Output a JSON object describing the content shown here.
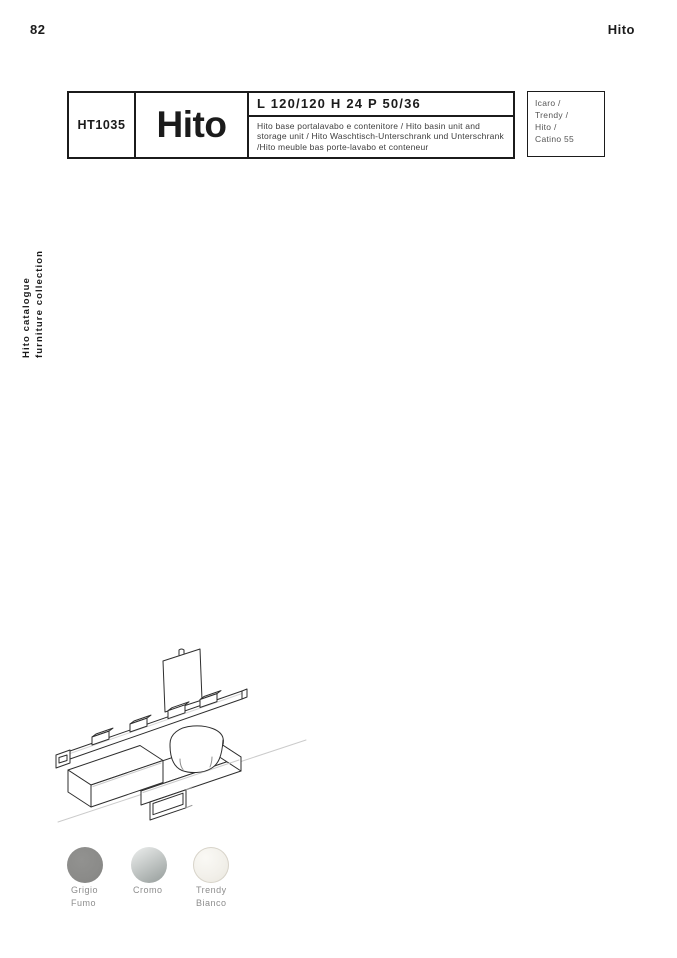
{
  "page": {
    "number": "82",
    "brand": "Hito"
  },
  "side_label": {
    "line1": "Hito catalogue",
    "line2": "furniture collection"
  },
  "product": {
    "code": "HT1035",
    "name": "Hito",
    "dimensions": "L 120/120 H 24 P 50/36",
    "description": "Hito base portalavabo e contenitore / Hito basin unit and storage unit / Hito Waschtisch-Unterschrank und Unterschrank  /Hito meuble bas porte-lavabo et conteneur",
    "compatible": {
      "line1": "Icaro /",
      "line2": "Trendy /",
      "line3": "Hito /",
      "line4": "Catino 55"
    }
  },
  "drawing": {
    "description": "isometric line drawing: wall rail with hooks, mirror panel, countertop with basin, storage units"
  },
  "finishes": {
    "items": [
      {
        "label_line1": "Grigio",
        "label_line2": "Fumo",
        "type": "solid",
        "color": "#8b8b89"
      },
      {
        "label_line1": "Cromo",
        "label_line2": "",
        "type": "gradient",
        "color_from": "#e9ebea",
        "color_to": "#99a09e"
      },
      {
        "label_line1": "Trendy",
        "label_line2": "Bianco",
        "type": "textured",
        "color": "#f2f0ea",
        "border": "#d8d4ca"
      }
    ]
  }
}
